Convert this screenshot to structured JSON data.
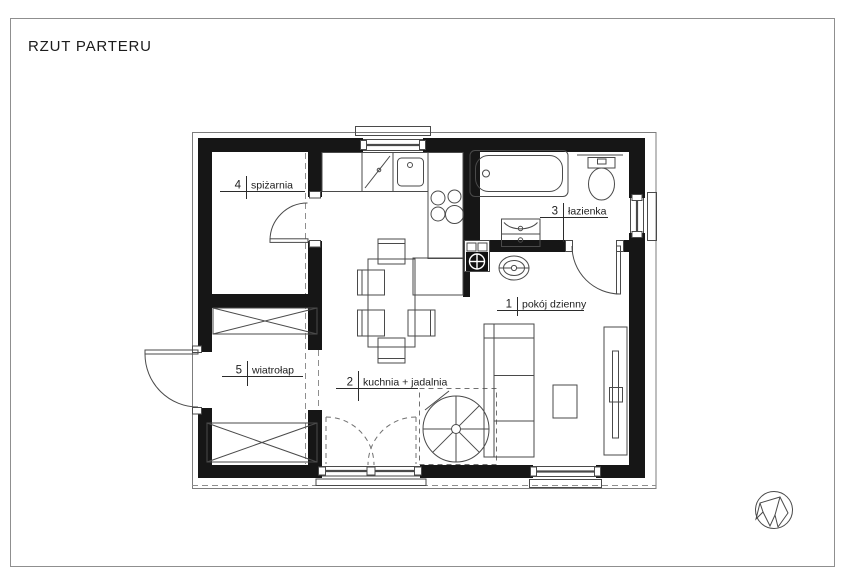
{
  "title": "RZUT PARTERU",
  "plan": {
    "rooms": [
      {
        "number": "1",
        "name": "pokój dzienny"
      },
      {
        "number": "2",
        "name": "kuchnia + jadalnia"
      },
      {
        "number": "3",
        "name": "łazienka"
      },
      {
        "number": "4",
        "name": "spiżarnia"
      },
      {
        "number": "5",
        "name": "wiatrołap"
      }
    ]
  },
  "icons": {
    "logo": "faceted-crystal-logo"
  },
  "colors": {
    "walls": "#161616",
    "furniture_lines": "#4a4a4a",
    "page_border": "#8f8f8f",
    "text": "#1c1c1c"
  }
}
